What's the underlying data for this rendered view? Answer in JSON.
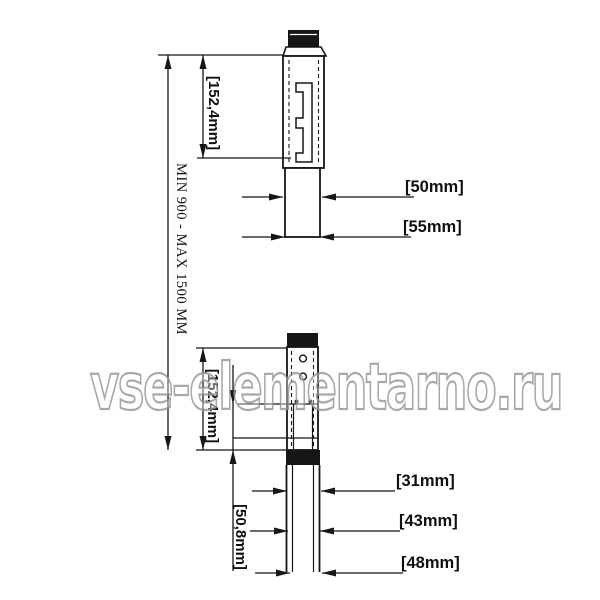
{
  "watermark": {
    "text": "vse-elementarno.ru"
  },
  "labels": {
    "overall_height": "MIN 900 - MAX 1500 MM",
    "upper_section_length": "[152,4mm]",
    "upper_tube_outer": "[50mm]",
    "upper_tube_base": "[55mm]",
    "lower_section_length": "[152,4mm]",
    "lower_overlap": "[50,8mm]",
    "bottom_tube_inner": "[31mm]",
    "bottom_tube_mid": "[43mm]",
    "bottom_tube_outer": "[48mm]"
  },
  "colors": {
    "line": "#161616",
    "background": "#ffffff",
    "watermark": "#969696"
  }
}
